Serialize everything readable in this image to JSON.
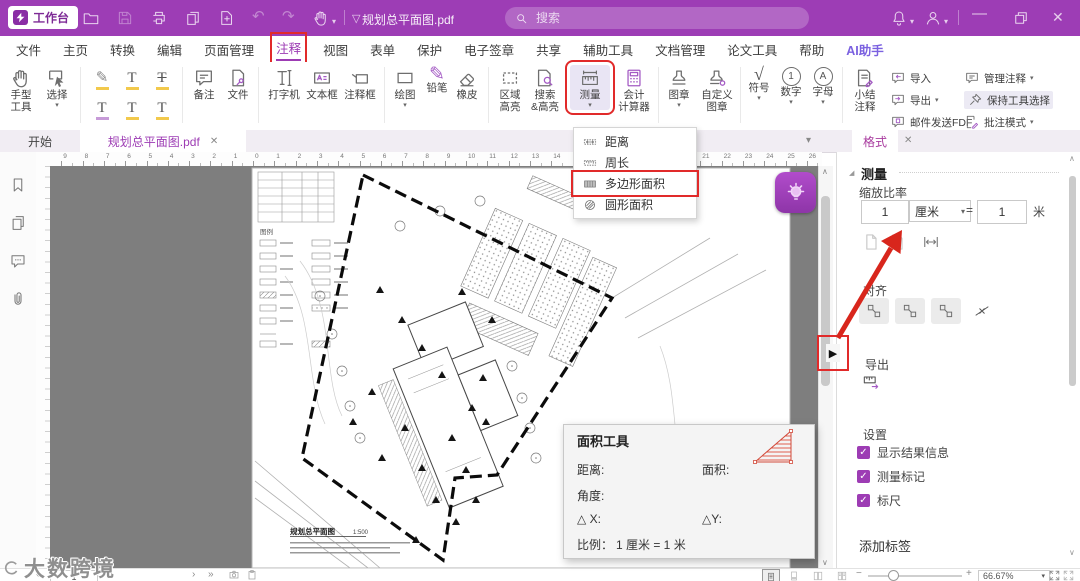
{
  "app": {
    "accent_color": "#9D3CB4",
    "annotation_color": "#E12A2A",
    "titlebar": {
      "workspace": "工作台",
      "filename": "规划总平面图.pdf",
      "search_placeholder": "搜索"
    }
  },
  "tabs": {
    "t0": "文件",
    "t1": "主页",
    "t2": "转换",
    "t3": "编辑",
    "t4": "页面管理",
    "t5": "注释",
    "t6": "视图",
    "t7": "表单",
    "t8": "保护",
    "t9": "电子签章",
    "t10": "共享",
    "t11": "辅助工具",
    "t12": "文档管理",
    "t13": "论文工具",
    "t14": "帮助",
    "t15": "AI助手",
    "active": "注释"
  },
  "ribbon": {
    "hand": "手型\n工具",
    "select": "选择",
    "note": "备注",
    "file": "文件",
    "typewriter": "打字机",
    "textbox": "文本框",
    "callout": "注释框",
    "draw": "绘图",
    "pencil": "铅笔",
    "eraser": "橡皮",
    "area_hl": "区域\n高亮",
    "search_hl": "搜索\n&高亮",
    "measure": "测量",
    "calc": "会计\n计算器",
    "stamp": "图章",
    "custom_stamp": "自定义\n图章",
    "symbol": "符号",
    "number": "数字",
    "letter": "字母",
    "summary": "小结\n注释",
    "import": "导入",
    "export": "导出",
    "mail_fdf": "邮件发送FDF",
    "manage": "管理注释",
    "keep_tool": "保持工具选择",
    "comment_mode": "批注模式"
  },
  "measure_menu": {
    "items": {
      "0": "距离",
      "1": "周长",
      "2": "多边形面积",
      "3": "圆形面积"
    },
    "highlighted": "多边形面积"
  },
  "doc_tabs": {
    "start": "开始",
    "active": "规划总平面图.pdf"
  },
  "panel": {
    "tab": "格式",
    "section_measure": "测量",
    "scale_label": "缩放比率",
    "from_value": "1",
    "from_unit": "厘米",
    "equals": "=",
    "to_value": "1",
    "to_unit": "米",
    "align_label": "对齐",
    "export_label": "导出",
    "settings_label": "设置",
    "cb1": "显示结果信息",
    "cb2": "测量标记",
    "cb3": "标尺",
    "add_tag": "添加标签"
  },
  "area_tool": {
    "title": "面积工具",
    "distance": "距离:",
    "area": "面积:",
    "angle": "角度:",
    "dx": "△ X:",
    "dy": "△Y:",
    "scale_label": "比例：",
    "scale_value": "1 厘米 = 1 米"
  },
  "drawing": {
    "legend": "图例",
    "title": "规划总平面图",
    "scale": "1:500"
  },
  "statusbar": {
    "page": "1",
    "zoom": "66.67%",
    "watermark": "大数跨境"
  },
  "ruler": {
    "zero_x": 253,
    "spacing": 21.3,
    "left_max": 9,
    "right_max": 26
  },
  "icons": {
    "caret_down": "▾",
    "chevron_up": "∧",
    "chevron_down": "∨",
    "close": "✕",
    "minimize": "—",
    "undo": "↶",
    "redo": "↷",
    "flag": "▽",
    "pencil": "✎",
    "radical": "√",
    "digit_one": "1",
    "letter_a": "A",
    "letter_t": "T",
    "check": "✓",
    "play": "▶",
    "next": "›",
    "last": "»"
  }
}
